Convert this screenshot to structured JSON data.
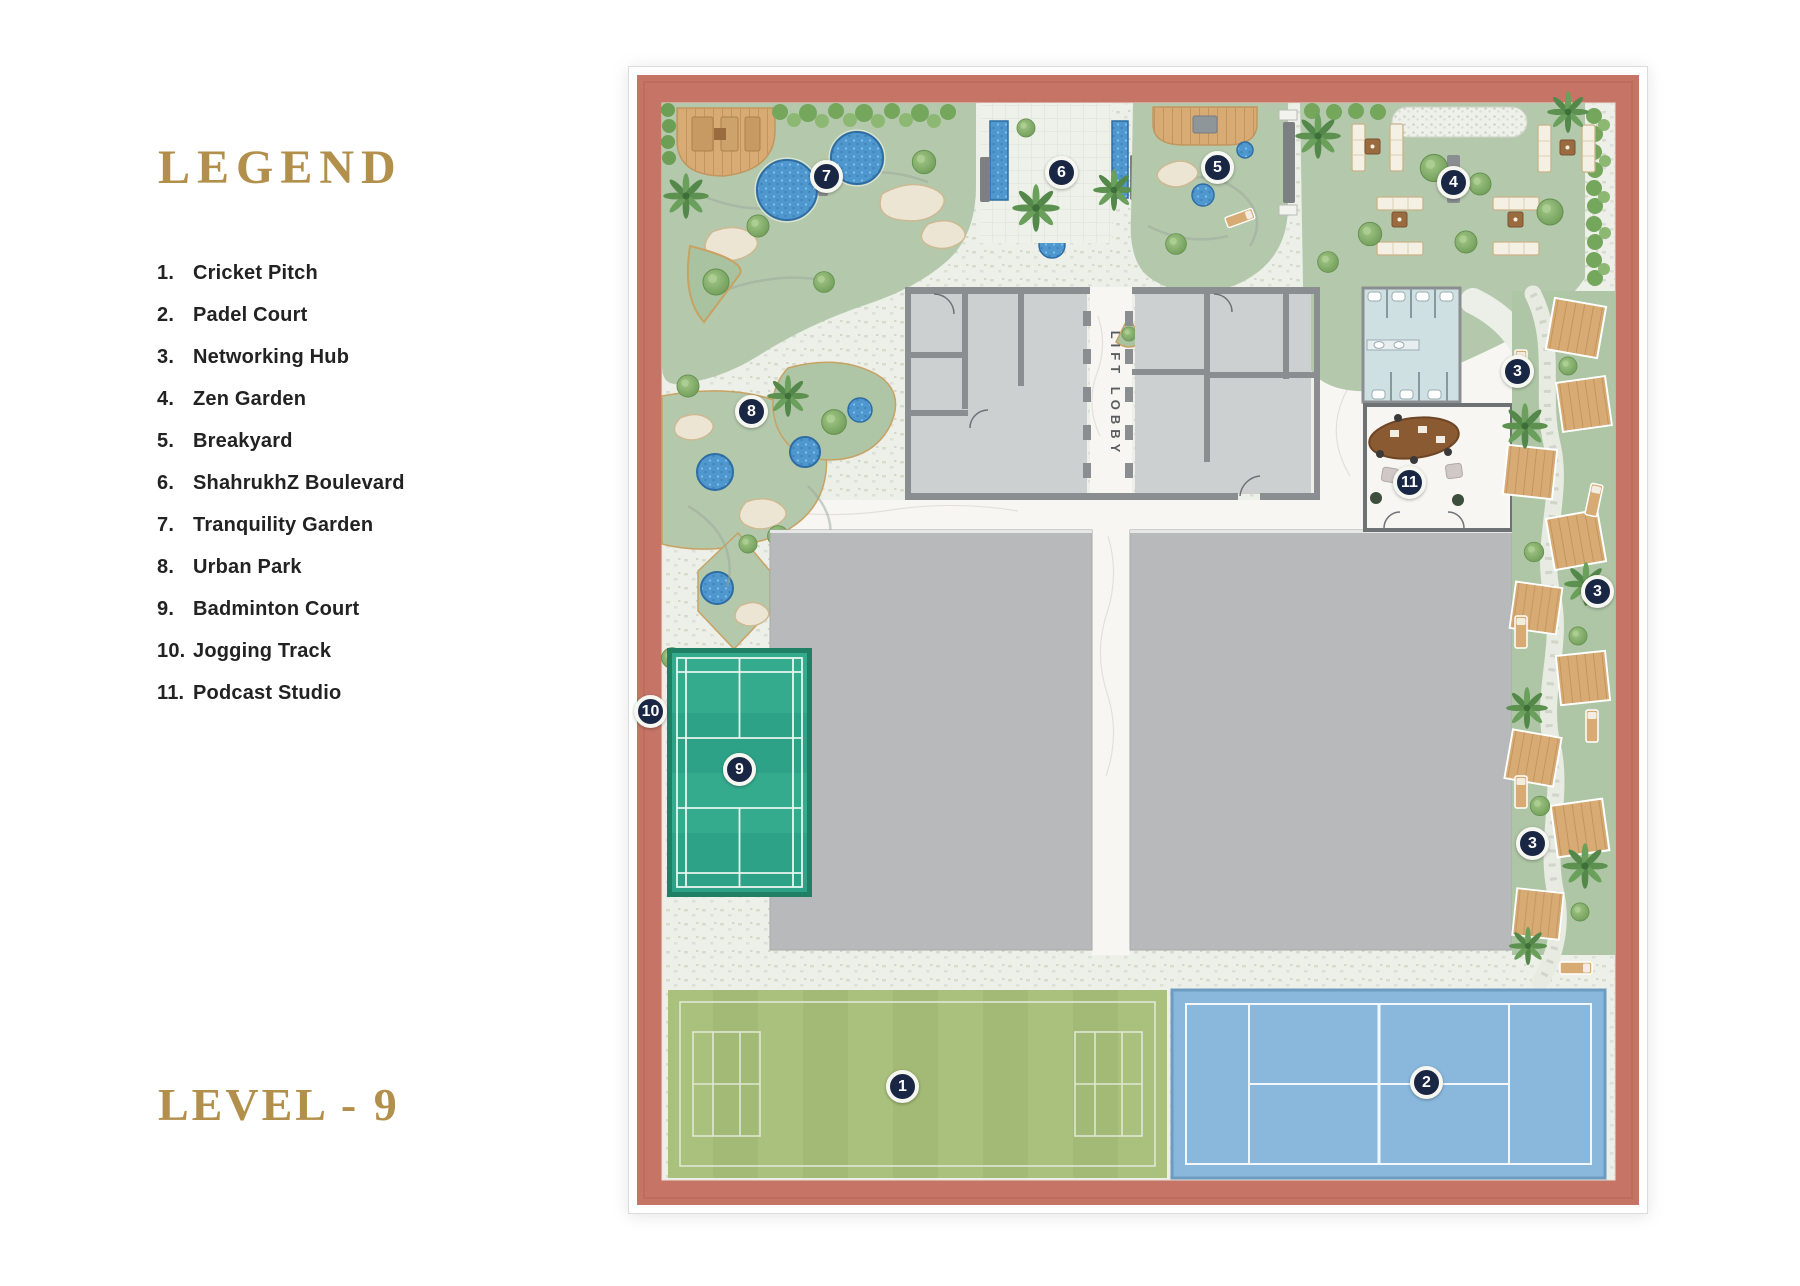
{
  "legend": {
    "title": "LEGEND",
    "items": [
      {
        "number": "1.",
        "label": "Cricket Pitch"
      },
      {
        "number": "2.",
        "label": "Padel Court"
      },
      {
        "number": "3.",
        "label": "Networking Hub"
      },
      {
        "number": "4.",
        "label": "Zen Garden"
      },
      {
        "number": "5.",
        "label": "Breakyard"
      },
      {
        "number": "6.",
        "label": "ShahrukhZ Boulevard"
      },
      {
        "number": "7.",
        "label": "Tranquility Garden"
      },
      {
        "number": "8.",
        "label": "Urban Park"
      },
      {
        "number": "9.",
        "label": "Badminton Court"
      },
      {
        "number": "10.",
        "label": "Jogging Track"
      },
      {
        "number": "11.",
        "label": "Podcast Studio"
      }
    ]
  },
  "level": {
    "label": "LEVEL - 9"
  },
  "plan": {
    "lift_lobby_label": "LIFT LOBBY",
    "markers": [
      {
        "number": "7",
        "feature": "Tranquility Garden"
      },
      {
        "number": "6",
        "feature": "ShahrukhZ Boulevard"
      },
      {
        "number": "5",
        "feature": "Breakyard"
      },
      {
        "number": "4",
        "feature": "Zen Garden"
      },
      {
        "number": "3",
        "feature": "Networking Hub"
      },
      {
        "number": "11",
        "feature": "Podcast Studio"
      },
      {
        "number": "3",
        "feature": "Networking Hub"
      },
      {
        "number": "8",
        "feature": "Urban Park"
      },
      {
        "number": "10",
        "feature": "Jogging Track"
      },
      {
        "number": "9",
        "feature": "Badminton Court"
      },
      {
        "number": "3",
        "feature": "Networking Hub"
      },
      {
        "number": "1",
        "feature": "Cricket Pitch"
      },
      {
        "number": "2",
        "feature": "Padel Court"
      }
    ],
    "colors": {
      "gold": "#b2904c",
      "legend_text": "#222222",
      "border_salmon": "#c57466",
      "garden_green": "#b4c9ac",
      "badminton_teal": "#2ea287",
      "cricket_green": "#a9c17d",
      "padel_blue": "#8ab8dc",
      "pool_blue": "#4f97cf",
      "marker_navy": "#1a2744",
      "wood_tan": "#d8ab74",
      "slab_gray": "#b7b9ba",
      "marble_white": "#f7f6f2"
    }
  }
}
